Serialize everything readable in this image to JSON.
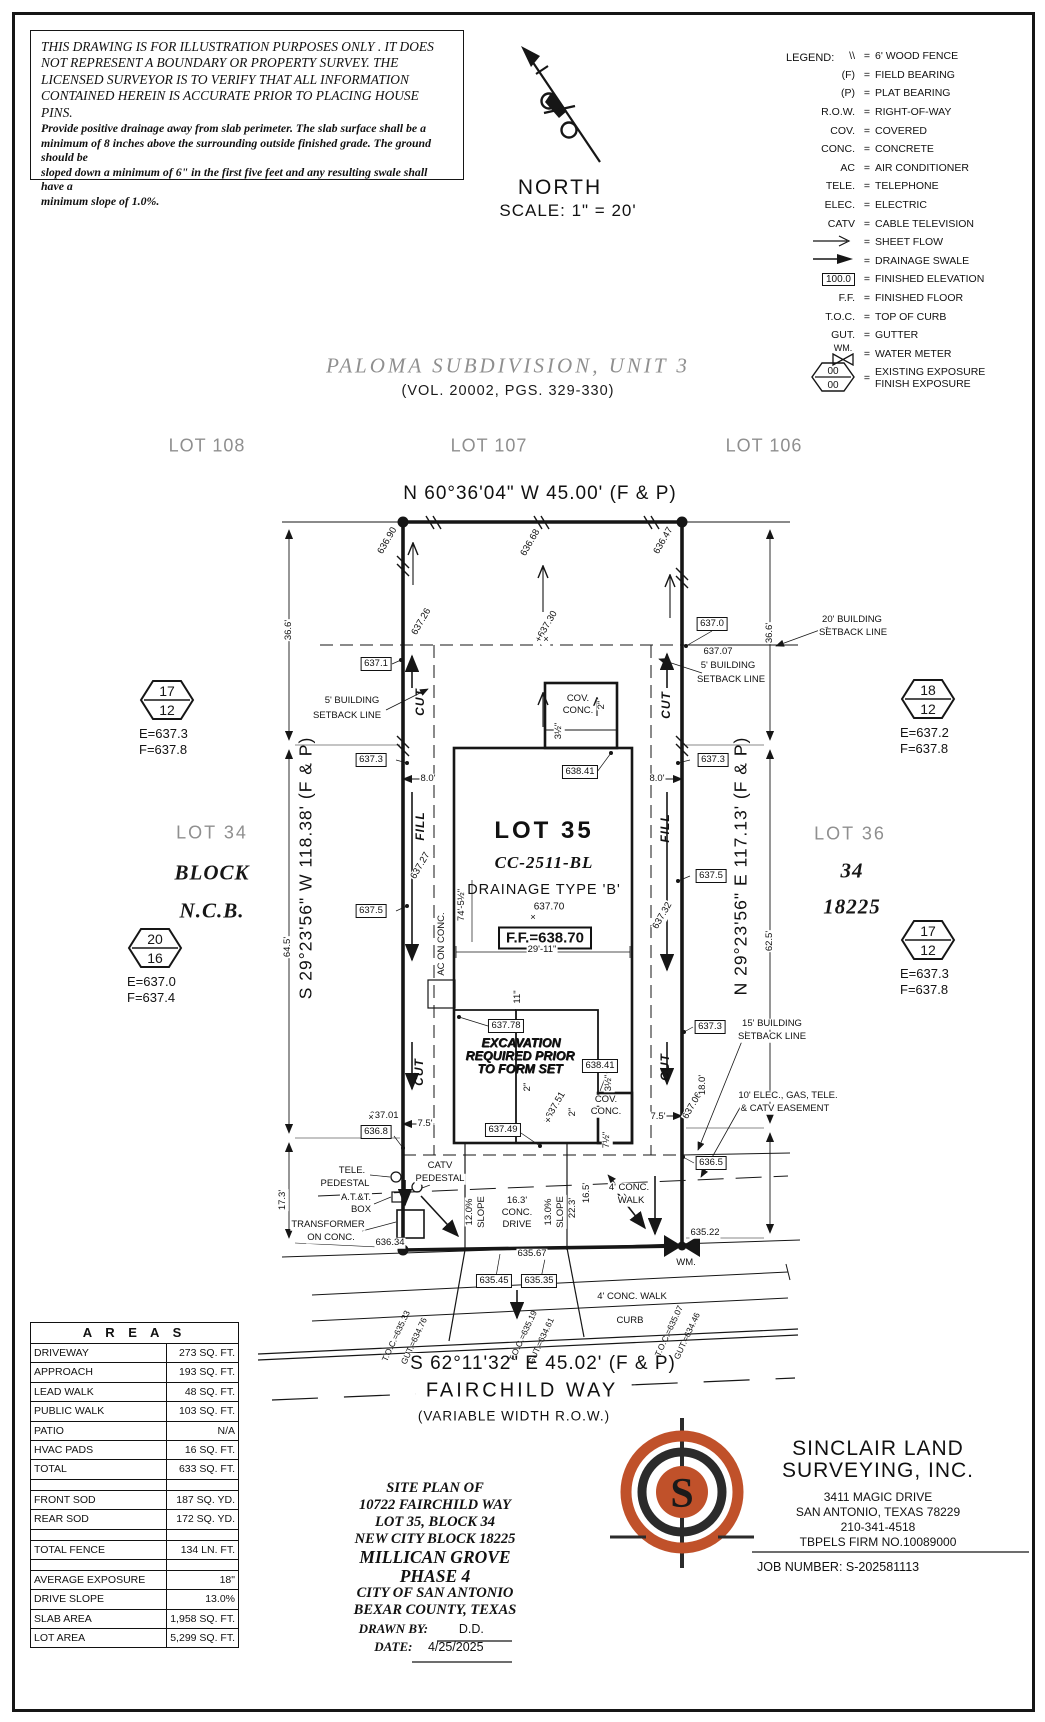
{
  "disclaimer": {
    "heading": [
      "THIS DRAWING IS FOR ILLUSTRATION PURPOSES ONLY . IT DOES",
      "NOT REPRESENT A BOUNDARY OR PROPERTY SURVEY. THE",
      "LICENSED SURVEYOR IS TO VERIFY THAT ALL INFORMATION",
      "CONTAINED HEREIN IS ACCURATE PRIOR TO PLACING HOUSE PINS."
    ],
    "body": [
      "Provide positive drainage away from slab perimeter. The slab surface shall be a",
      "minimum of 8 inches above the surrounding outside finished grade. The ground should be",
      "sloped down a minimum of 6\" in the first five feet and any resulting swale shall have a",
      "minimum slope of 1.0%."
    ]
  },
  "north": {
    "label": "NORTH",
    "scale": "SCALE:  1\"  =  20'"
  },
  "legend": {
    "title": "LEGEND:",
    "eq": "=",
    "rows": [
      {
        "sym": "\\\\",
        "desc": "6' WOOD FENCE"
      },
      {
        "sym": "(F)",
        "desc": "FIELD BEARING"
      },
      {
        "sym": "(P)",
        "desc": "PLAT BEARING"
      },
      {
        "sym": "R.O.W.",
        "desc": "RIGHT-OF-WAY"
      },
      {
        "sym": "COV.",
        "desc": "COVERED"
      },
      {
        "sym": "CONC.",
        "desc": "CONCRETE"
      },
      {
        "sym": "AC",
        "desc": "AIR CONDITIONER"
      },
      {
        "sym": "TELE.",
        "desc": "TELEPHONE"
      },
      {
        "sym": "ELEC.",
        "desc": "ELECTRIC"
      },
      {
        "sym": "CATV",
        "desc": "CABLE TELEVISION"
      },
      {
        "type": "arrow_open",
        "desc": "SHEET FLOW"
      },
      {
        "type": "arrow_solid",
        "desc": "DRAINAGE SWALE"
      },
      {
        "type": "box",
        "sym": "100.0",
        "desc": "FINISHED ELEVATION"
      },
      {
        "sym": "F.F.",
        "desc": "FINISHED FLOOR"
      },
      {
        "sym": "T.O.C.",
        "desc": "TOP OF CURB"
      },
      {
        "sym": "GUT.",
        "desc": "GUTTER"
      },
      {
        "type": "wm",
        "sym": "WM.",
        "desc": "WATER METER"
      },
      {
        "type": "hex",
        "sym_top": "00",
        "sym_bottom": "00",
        "desc": "EXISTING EXPOSURE",
        "desc2": "FINISH EXPOSURE"
      }
    ]
  },
  "subdivision": {
    "title": "PALOMA SUBDIVISION,  UNIT 3",
    "volume": "(VOL. 20002, PGS. 329-330)"
  },
  "adjacent_lots": {
    "left": "LOT 108",
    "center": "LOT 107",
    "right": "LOT 106"
  },
  "bearings": {
    "north": "N 60°36'04\" W 45.00' (F & P)",
    "south": "S 62°11'32\" E 45.02' (F & P)",
    "west": "S 29°23'56\" W 118.38' (F & P)",
    "east": "N 29°23'56\" E 117.13' (F & P)"
  },
  "street": {
    "name": "FAIRCHILD WAY",
    "row": "(VARIABLE WIDTH R.O.W.)"
  },
  "side_lots": {
    "left": [
      "LOT 34",
      "BLOCK",
      "N.C.B."
    ],
    "right": [
      "LOT 36",
      "34",
      "18225"
    ]
  },
  "lot35": {
    "name": "LOT 35",
    "code": "CC-2511-BL",
    "drainage": "DRAINAGE TYPE 'B'",
    "spot": "637.70",
    "ff": "F.F.=638.70"
  },
  "exposure_markers": [
    {
      "top": "17",
      "bottom": "12",
      "e": "E=637.3",
      "f": "F=637.8",
      "x": 167,
      "y": 700
    },
    {
      "top": "20",
      "bottom": "16",
      "e": "E=637.0",
      "f": "F=637.4",
      "x": 155,
      "y": 948
    },
    {
      "top": "18",
      "bottom": "12",
      "e": "E=637.2",
      "f": "F=637.8",
      "x": 928,
      "y": 699
    },
    {
      "top": "17",
      "bottom": "12",
      "e": "E=637.3",
      "f": "F=637.8",
      "x": 928,
      "y": 940
    }
  ],
  "areas_table": {
    "title": "A R E A S",
    "rows": [
      [
        "DRIVEWAY",
        "273 SQ. FT."
      ],
      [
        "APPROACH",
        "193 SQ. FT."
      ],
      [
        "LEAD WALK",
        "48 SQ. FT."
      ],
      [
        "PUBLIC WALK",
        "103 SQ. FT."
      ],
      [
        "PATIO",
        "N/A"
      ],
      [
        "HVAC PADS",
        "16 SQ. FT."
      ],
      [
        "TOTAL",
        "633 SQ. FT."
      ],
      [
        "",
        ""
      ],
      [
        "FRONT SOD",
        "187 SQ. YD."
      ],
      [
        "REAR SOD",
        "172 SQ. YD."
      ],
      [
        "",
        ""
      ],
      [
        "TOTAL FENCE",
        "134 LN. FT."
      ],
      [
        "",
        ""
      ],
      [
        "AVERAGE EXPOSURE",
        "18\""
      ],
      [
        "DRIVE SLOPE",
        "13.0%"
      ],
      [
        "SLAB AREA",
        "1,958 SQ. FT."
      ],
      [
        "LOT AREA",
        "5,299 SQ. FT."
      ]
    ]
  },
  "title_block": {
    "lines": [
      "SITE PLAN OF",
      "10722 FAIRCHILD WAY",
      "LOT 35, BLOCK 34",
      "NEW CITY BLOCK 18225",
      "MILLICAN GROVE",
      "PHASE 4",
      "CITY OF SAN ANTONIO",
      "BEXAR COUNTY, TEXAS"
    ],
    "drawn_by_label": "DRAWN BY:",
    "drawn_by_value": "D.D.",
    "date_label": "DATE:",
    "date_value": "4/25/2025"
  },
  "surveyor": {
    "name1": "SINCLAIR LAND",
    "name2": "SURVEYING, INC.",
    "address": [
      "3411 MAGIC DRIVE",
      "SAN ANTONIO, TEXAS 78229",
      "210-341-4518",
      "TBPELS FIRM NO.10089000"
    ],
    "job": "JOB NUMBER:  S-202581113"
  },
  "plat_labels": [
    {
      "t": "636.90",
      "x": 388,
      "y": 541,
      "r": -60
    },
    {
      "t": "636.68",
      "x": 531,
      "y": 543,
      "r": -60
    },
    {
      "t": "636.47",
      "x": 664,
      "y": 541,
      "r": -60
    },
    {
      "t": "637.26",
      "x": 422,
      "y": 622,
      "r": -60
    },
    {
      "t": "+637.30",
      "x": 547,
      "y": 627,
      "r": -60
    },
    {
      "t": "20' BUILDING",
      "x": 852,
      "y": 620
    },
    {
      "t": "SETBACK LINE",
      "x": 853,
      "y": 633
    },
    {
      "t": "637.0",
      "x": 712,
      "y": 624,
      "c": "box"
    },
    {
      "t": "637.07",
      "x": 718,
      "y": 652
    },
    {
      "t": "5' BUILDING",
      "x": 728,
      "y": 666
    },
    {
      "t": "SETBACK LINE",
      "x": 731,
      "y": 680
    },
    {
      "t": "36.6'",
      "x": 289,
      "y": 630,
      "r": -90
    },
    {
      "t": "36.6'",
      "x": 770,
      "y": 633,
      "r": -90
    },
    {
      "t": "637.1",
      "x": 376,
      "y": 664,
      "c": "box"
    },
    {
      "t": "5' BUILDING",
      "x": 352,
      "y": 701
    },
    {
      "t": "SETBACK LINE",
      "x": 347,
      "y": 716
    },
    {
      "t": "CUT",
      "x": 420,
      "y": 702,
      "r": -90,
      "c": "cf"
    },
    {
      "t": "CUT",
      "x": 666,
      "y": 705,
      "r": -90,
      "c": "cf"
    },
    {
      "t": "COV.",
      "x": 578,
      "y": 699
    },
    {
      "t": "CONC.",
      "x": 578,
      "y": 711
    },
    {
      "t": "2\"",
      "x": 602,
      "y": 705,
      "r": -90
    },
    {
      "t": "3½\"",
      "x": 559,
      "y": 731,
      "r": -90
    },
    {
      "t": "638.41",
      "x": 580,
      "y": 772,
      "c": "box"
    },
    {
      "t": "637.3",
      "x": 371,
      "y": 760,
      "c": "box"
    },
    {
      "t": "637.3",
      "x": 713,
      "y": 760,
      "c": "box"
    },
    {
      "t": "8.0'",
      "x": 428,
      "y": 779
    },
    {
      "t": "8.0'",
      "x": 657,
      "y": 779
    },
    {
      "t": "FILL",
      "x": 420,
      "y": 826,
      "r": -90,
      "c": "cf"
    },
    {
      "t": "FILL",
      "x": 665,
      "y": 828,
      "r": -90,
      "c": "cf"
    },
    {
      "t": "637.27",
      "x": 421,
      "y": 866,
      "r": -60
    },
    {
      "t": "637.32",
      "x": 663,
      "y": 916,
      "r": -60
    },
    {
      "t": "637.5",
      "x": 371,
      "y": 911,
      "c": "box"
    },
    {
      "t": "637.5",
      "x": 711,
      "y": 876,
      "c": "box"
    },
    {
      "t": "74'-5½\"",
      "x": 462,
      "y": 905,
      "r": -90
    },
    {
      "t": "AC ON CONC.",
      "x": 442,
      "y": 944,
      "r": -90
    },
    {
      "t": "29'-11\"",
      "x": 542,
      "y": 950
    },
    {
      "t": "11\"",
      "x": 518,
      "y": 997,
      "r": -90
    },
    {
      "t": "637.78",
      "x": 506,
      "y": 1026,
      "c": "box"
    },
    {
      "t": "EXCAVATION",
      "x": 521,
      "y": 1043,
      "c": "exc"
    },
    {
      "t": "REQUIRED PRIOR",
      "x": 520,
      "y": 1056,
      "c": "exc"
    },
    {
      "t": "TO FORM SET",
      "x": 520,
      "y": 1069,
      "c": "exc"
    },
    {
      "t": "638.41",
      "x": 600,
      "y": 1066,
      "c": "box"
    },
    {
      "t": "637.3",
      "x": 710,
      "y": 1027,
      "c": "box"
    },
    {
      "t": "2\"",
      "x": 528,
      "y": 1087,
      "r": -90
    },
    {
      "t": "×637.51",
      "x": 555,
      "y": 1108,
      "r": -60
    },
    {
      "t": "2\"",
      "x": 573,
      "y": 1112,
      "r": -90
    },
    {
      "t": "COV.",
      "x": 606,
      "y": 1100
    },
    {
      "t": "CONC.",
      "x": 606,
      "y": 1112
    },
    {
      "t": "3½\"",
      "x": 609,
      "y": 1083,
      "r": -90
    },
    {
      "t": "7½\"",
      "x": 607,
      "y": 1140,
      "r": -90
    },
    {
      "t": "637.49",
      "x": 503,
      "y": 1130,
      "c": "box"
    },
    {
      "t": "637.01",
      "x": 384,
      "y": 1116
    },
    {
      "t": "636.8",
      "x": 376,
      "y": 1132,
      "c": "box"
    },
    {
      "t": "7.5'",
      "x": 425,
      "y": 1124
    },
    {
      "t": "7.5'",
      "x": 658,
      "y": 1117
    },
    {
      "t": "637.06",
      "x": 693,
      "y": 1106,
      "r": -60
    },
    {
      "t": "636.5",
      "x": 711,
      "y": 1163,
      "c": "box"
    },
    {
      "t": "15' BUILDING",
      "x": 772,
      "y": 1024
    },
    {
      "t": "SETBACK LINE",
      "x": 772,
      "y": 1037
    },
    {
      "t": "18.0'",
      "x": 703,
      "y": 1085,
      "r": -90
    },
    {
      "t": "10' ELEC., GAS, TELE.",
      "x": 788,
      "y": 1096
    },
    {
      "t": "& CATV EASEMENT",
      "x": 785,
      "y": 1109
    },
    {
      "t": "CUT",
      "x": 419,
      "y": 1072,
      "r": -90,
      "c": "cf"
    },
    {
      "t": "CUT",
      "x": 665,
      "y": 1067,
      "r": -90,
      "c": "cf"
    },
    {
      "t": "TELE.",
      "x": 352,
      "y": 1171
    },
    {
      "t": "PEDESTAL",
      "x": 345,
      "y": 1184
    },
    {
      "t": "CATV",
      "x": 440,
      "y": 1166
    },
    {
      "t": "PEDESTAL",
      "x": 440,
      "y": 1179
    },
    {
      "t": "A.T.&T.",
      "x": 356,
      "y": 1198
    },
    {
      "t": "BOX",
      "x": 361,
      "y": 1210
    },
    {
      "t": "TRANSFORMER",
      "x": 328,
      "y": 1225
    },
    {
      "t": "ON CONC.",
      "x": 331,
      "y": 1238
    },
    {
      "t": "17.3'",
      "x": 283,
      "y": 1200,
      "r": -90
    },
    {
      "t": "636.34",
      "x": 390,
      "y": 1243
    },
    {
      "t": "12.0%",
      "x": 470,
      "y": 1212,
      "r": -90
    },
    {
      "t": "SLOPE",
      "x": 482,
      "y": 1212,
      "r": -90
    },
    {
      "t": "16.3'",
      "x": 517,
      "y": 1201
    },
    {
      "t": "CONC.",
      "x": 517,
      "y": 1213
    },
    {
      "t": "DRIVE",
      "x": 517,
      "y": 1225
    },
    {
      "t": "13.0%",
      "x": 549,
      "y": 1212,
      "r": -90
    },
    {
      "t": "SLOPE",
      "x": 561,
      "y": 1212,
      "r": -90
    },
    {
      "t": "22.3'",
      "x": 573,
      "y": 1208,
      "r": -90
    },
    {
      "t": "16.5'",
      "x": 587,
      "y": 1193,
      "r": -90
    },
    {
      "t": "4' CONC.",
      "x": 629,
      "y": 1188
    },
    {
      "t": "WALK",
      "x": 631,
      "y": 1201
    },
    {
      "t": "635.22",
      "x": 705,
      "y": 1233
    },
    {
      "t": "WM.",
      "x": 686,
      "y": 1263
    },
    {
      "t": "635.67",
      "x": 532,
      "y": 1254
    },
    {
      "t": "635.45",
      "x": 494,
      "y": 1281,
      "c": "box"
    },
    {
      "t": "635.35",
      "x": 539,
      "y": 1281,
      "c": "box"
    },
    {
      "t": "4' CONC. WALK",
      "x": 632,
      "y": 1297
    },
    {
      "t": "CURB",
      "x": 630,
      "y": 1321
    },
    {
      "t": "T.O.C.=635.33",
      "x": 396,
      "y": 1336,
      "r": -65,
      "c": "toc"
    },
    {
      "t": "GUT.=634.76",
      "x": 414,
      "y": 1341,
      "r": -65,
      "c": "toc"
    },
    {
      "t": "T.O.C.=635.19",
      "x": 523,
      "y": 1336,
      "r": -65,
      "c": "toc"
    },
    {
      "t": "GUT.=634.61",
      "x": 541,
      "y": 1341,
      "r": -65,
      "c": "toc"
    },
    {
      "t": "T.O.C.=635.07",
      "x": 669,
      "y": 1331,
      "r": -65,
      "c": "toc"
    },
    {
      "t": "GUT.=634.46",
      "x": 687,
      "y": 1336,
      "r": -65,
      "c": "toc"
    },
    {
      "t": "64.5'",
      "x": 288,
      "y": 947,
      "r": -90
    },
    {
      "t": "62.5'",
      "x": 770,
      "y": 941,
      "r": -90
    },
    {
      "t": "×",
      "x": 546,
      "y": 640
    },
    {
      "t": "×",
      "x": 533,
      "y": 918
    },
    {
      "t": "×",
      "x": 548,
      "y": 1121
    },
    {
      "t": "×",
      "x": 371,
      "y": 1118
    }
  ],
  "colors": {
    "accent_orange": "#c0512a",
    "ink": "#161616",
    "gray_text": "#8f8f8f"
  }
}
